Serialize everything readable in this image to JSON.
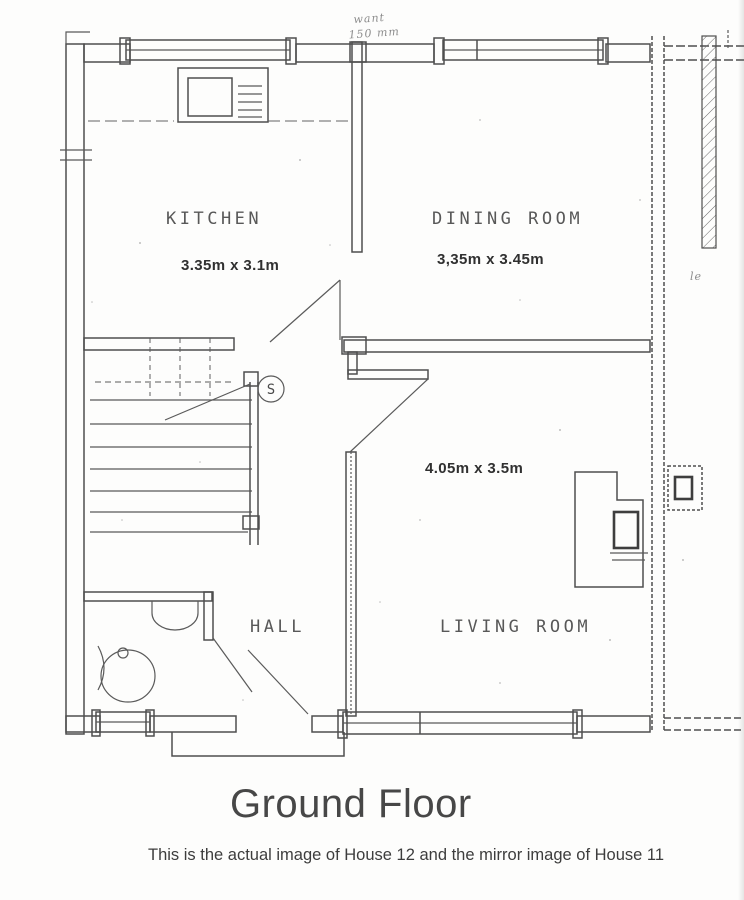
{
  "document": {
    "title": "Ground Floor",
    "caption": "This is the actual image of House 12 and the mirror image of House 11"
  },
  "plan": {
    "rooms": {
      "kitchen": {
        "label": "KITCHEN",
        "dims": "3.35m x 3.1m"
      },
      "dining": {
        "label": "DINING ROOM",
        "dims": "3,35m x 3.45m"
      },
      "living": {
        "label": "LIVING ROOM",
        "dims": "4.05m x 3.5m"
      },
      "hall": {
        "label": "HALL"
      }
    },
    "symbols": {
      "smoke_detector": "S"
    },
    "annotations": {
      "wall_note_line1": "want",
      "wall_note_line2": "150 mm",
      "side_note": "le"
    },
    "colors": {
      "ink": "#4e4e4e",
      "label": "#585858",
      "faint": "#8d8d8d"
    }
  }
}
